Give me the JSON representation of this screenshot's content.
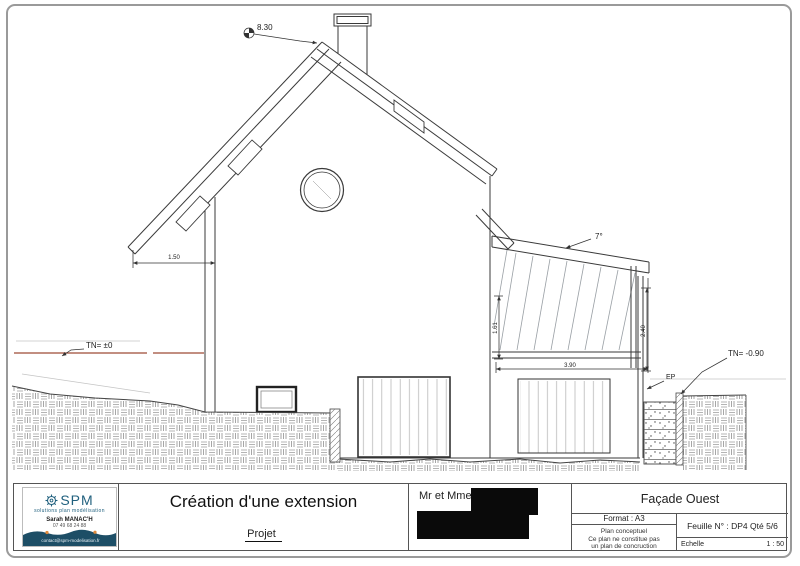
{
  "drawing": {
    "annotations": {
      "ridge_level": "8.30",
      "roof_angle": "7°",
      "tn_left": "TN= ±0",
      "tn_right": "TN= -0.90",
      "ep": "EP",
      "dim_overhang": "1.50",
      "dim_ext_height_left": "1.61",
      "dim_ext_height_right": "2.40",
      "dim_ext_width": "3.90"
    }
  },
  "title_block": {
    "company": {
      "name": "SPM",
      "tagline": "solutions plan modélisation",
      "contact_name": "Sarah MANAC'H",
      "phone": "07 49 68 24 88",
      "email": "contact@spm-modelisation.fr",
      "logo_icon": "gear-icon"
    },
    "project_title": "Création d'une extension",
    "project_subtitle": "Projet",
    "client_label": "Mr et Mme",
    "view_title": "Façade Ouest",
    "format_label": "Format : A3",
    "disclaimer_line1": "Plan conceptuel",
    "disclaimer_line2": "Ce plan ne constitue pas",
    "disclaimer_line3": "un plan de concruction",
    "sheet_label": "Feuille N° : DP4 Qté 5/6",
    "scale_label": "Echelle",
    "scale_value": "1 : 50"
  },
  "colors": {
    "line": "#3a3a3a",
    "terrain_level_line": "#9e4b36",
    "brand_navy": "#1d4e66",
    "brand_orange": "#e08a3c",
    "redaction": "#0a0a0a"
  }
}
